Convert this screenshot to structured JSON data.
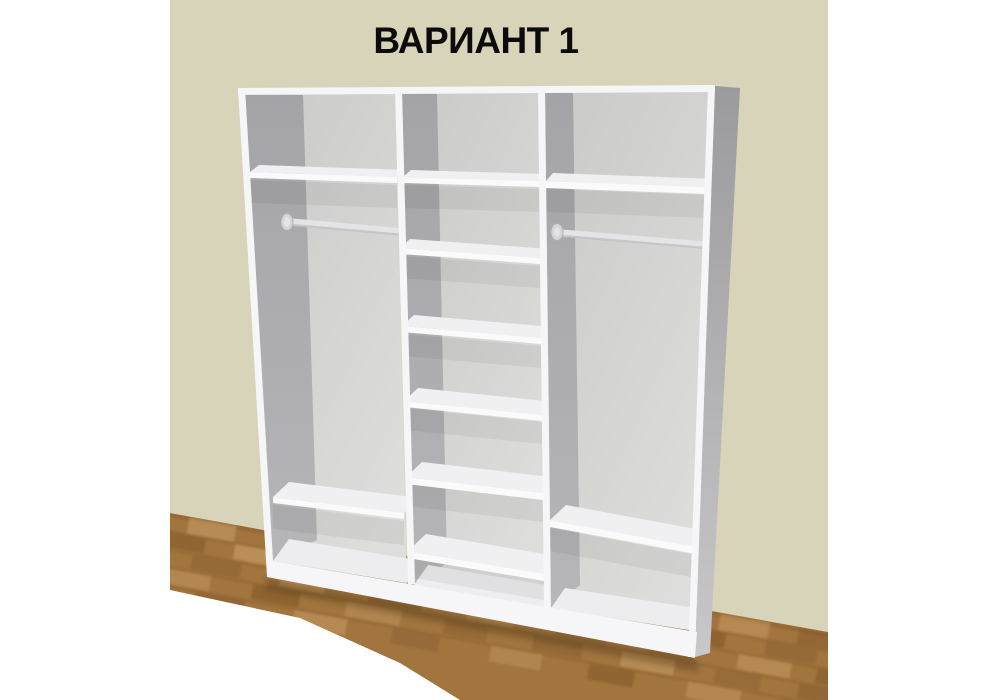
{
  "title": "ВАРИАНТ 1",
  "scene": {
    "type": "3D render of an open three-section white wardrobe interior standing against a wall",
    "wall": "plain beige painted wall",
    "floor": "oak basket-weave parquet",
    "sections": [
      {
        "position": "left",
        "shelves": 2,
        "hanging_rod": true,
        "compartments": [
          "top shelf compartment",
          "tall hanging space with rod",
          "low shelf compartment",
          "base compartment"
        ]
      },
      {
        "position": "middle",
        "shelves": 6,
        "hanging_rod": false,
        "compartments": [
          "seven stacked shelf compartments"
        ]
      },
      {
        "position": "right",
        "shelves": 2,
        "hanging_rod": true,
        "compartments": [
          "top shelf compartment",
          "tall hanging space with rod",
          "low shelf compartment",
          "base compartment"
        ]
      }
    ]
  },
  "colors": {
    "page_bg": "#ffffff",
    "title": "#0b0b0b",
    "wall": "#d8d4ba",
    "parquet_base": "#a2743e",
    "parquet_light": "#c99e66",
    "parquet_dark": "#7a5325",
    "parquet_mid": "#8d6233",
    "white_face": "#f6f6f8",
    "shelf_top": "#f0f0f3",
    "shelf_edge": "#fafafb",
    "back_dark": "#c9c9c7",
    "back_light": "#dddddb",
    "inner_wall": "#a4a4a6",
    "inner_wall_light": "#b6b6b8",
    "side_dark": "#9b9b9d",
    "side_light": "#c8c8ca",
    "floor_wedge": "#ededf0",
    "rod": "#e4e4e6",
    "rod_shadow": "#bebec0",
    "flange": "#d5d5d7",
    "flange_rim": "#b0b0b2"
  }
}
